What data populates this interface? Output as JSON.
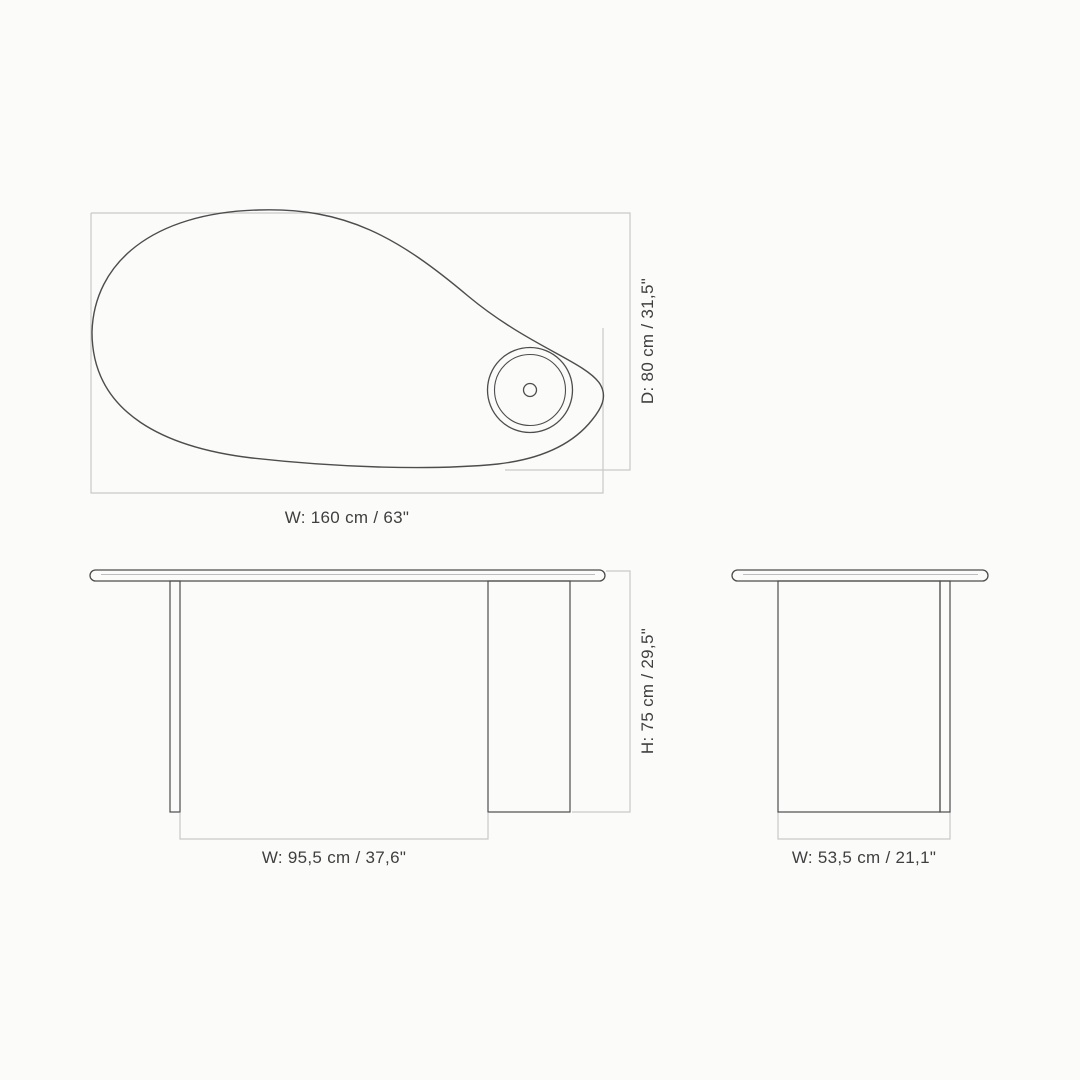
{
  "page": {
    "background": "#fbfbfa"
  },
  "colors": {
    "outline": "#4d4d4d",
    "dimension_box": "#c9c9c9",
    "detail_line": "#a8a8a8",
    "label_text": "#3f3f3f"
  },
  "views": {
    "top": {
      "width_label": "W: 160 cm / 63\"",
      "depth_label": "D: 80 cm / 31,5\""
    },
    "front": {
      "width_label": "W: 95,5 cm / 37,6\"",
      "height_label": "H: 75 cm / 29,5\""
    },
    "side": {
      "width_label": "W: 53,5 cm / 21,1\""
    }
  }
}
